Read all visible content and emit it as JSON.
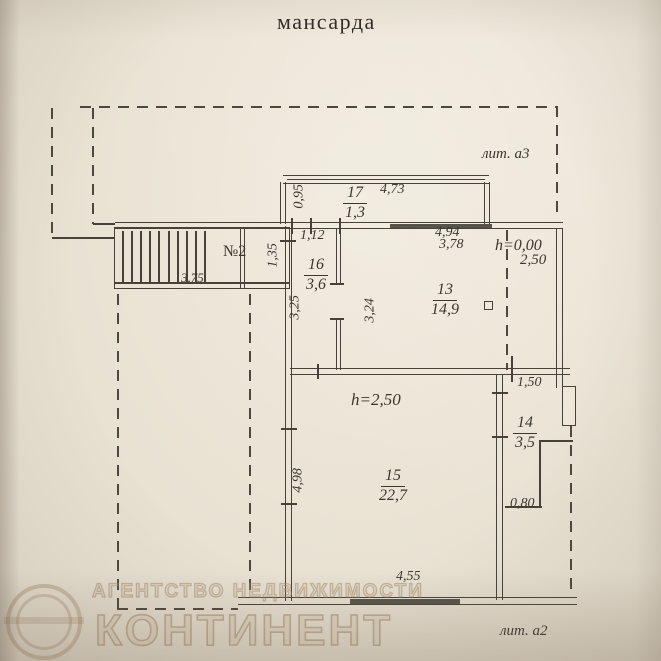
{
  "document": {
    "title": "мансарда",
    "litera_top": "лит. а3",
    "litera_bottom": "лит. а2"
  },
  "stairs": {
    "label": "№2"
  },
  "rooms": {
    "r17": {
      "number": "17",
      "area": "1,3"
    },
    "r16": {
      "number": "16",
      "area": "3,6"
    },
    "r13": {
      "number": "13",
      "area": "14,9"
    },
    "r14": {
      "number": "14",
      "area": "3,5"
    },
    "r15": {
      "number": "15",
      "area": "22,7"
    }
  },
  "heights": {
    "r13_mark": "h=0,00",
    "r13_value": "2,50",
    "r15_mark": "h=2,50"
  },
  "dimensions": {
    "balcony_width": "4,73",
    "balcony_depth": "0,95",
    "r16_width": "1,12",
    "r16_depth": "3,25",
    "landing_width": "1,35",
    "stair_length": "3,75",
    "r13_width_outer": "4,94",
    "r13_width_inner": "3,78",
    "r13_depth": "3,24",
    "r14_width": "1,50",
    "r14_niche": "0,80",
    "r15_depth": "4,98",
    "r15_width": "4,55"
  },
  "watermark": {
    "line1": "АГЕНТСТВО НЕДВИЖИМОСТИ",
    "line2": "КОНТИНЕНТ"
  },
  "colors": {
    "ink": "#46423a",
    "paper": "#e8e1d2",
    "dark_wall": "#57534a"
  }
}
